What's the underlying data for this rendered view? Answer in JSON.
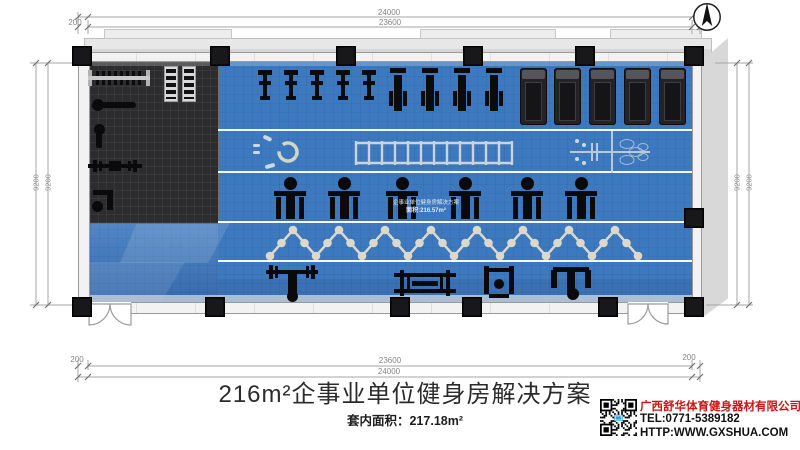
{
  "page": {
    "background": "#ffffff"
  },
  "compass": {
    "icon": "north-arrow"
  },
  "dims": {
    "top_total": "24000",
    "top_inner": "23600",
    "top_offset": "200",
    "bottom_inner": "23600",
    "bottom_total": "24000",
    "bottom_offset_left": "200",
    "bottom_offset_right": "200",
    "left_outer": "9200",
    "left_inner": "9200",
    "right_inner": "9200",
    "right_outer": "9200"
  },
  "plan": {
    "colors": {
      "floor_blue": "#3d79bf",
      "free_weight_floor": "#2c2c2e",
      "wall": "#f2f2f2",
      "column": "#18181a",
      "marking": "#ccd3da",
      "zigzag": "#dcd9cb"
    },
    "floor_label": {
      "line1": "企事业单位健身房解决方案",
      "line2": "面积:216.57m²"
    },
    "columns": {
      "top_x": [
        72,
        210,
        336,
        463,
        575,
        684
      ],
      "bottom_x": [
        72,
        205,
        390,
        462,
        598,
        684
      ],
      "right_side": [
        {
          "x": 684,
          "y": 208
        }
      ]
    },
    "equipment": {
      "groups": [
        {
          "type": "spin-bike",
          "y": 70,
          "xs": [
            258,
            284,
            310,
            336,
            362
          ]
        },
        {
          "type": "elliptical",
          "y": 67,
          "xs": [
            389,
            421,
            453,
            485
          ]
        },
        {
          "type": "treadmill",
          "y": 68,
          "xs": [
            520,
            554,
            589,
            624,
            659
          ]
        },
        {
          "type": "strength-machine",
          "y": 177,
          "xs": [
            274,
            328,
            386,
            449,
            511,
            565
          ]
        }
      ],
      "items": [
        {
          "type": "plate-rack",
          "x": 88,
          "y": 70
        },
        {
          "type": "dumbbell-rack",
          "x": 164,
          "y": 66
        },
        {
          "type": "dumbbell-rack",
          "x": 182,
          "y": 66
        },
        {
          "type": "adjustable-bench",
          "x": 92,
          "y": 98
        },
        {
          "type": "flat-bench",
          "x": 88,
          "y": 124
        },
        {
          "type": "barbell-bench",
          "x": 88,
          "y": 157
        },
        {
          "type": "preacher-bench",
          "x": 90,
          "y": 190
        },
        {
          "type": "bench-press-station",
          "x": 266,
          "y": 264
        },
        {
          "type": "barbell-rack",
          "x": 394,
          "y": 268
        },
        {
          "type": "squat-stand",
          "x": 484,
          "y": 266
        },
        {
          "type": "pendulum-machine",
          "x": 551,
          "y": 264
        }
      ]
    }
  },
  "footer": {
    "title": "216m²企事业单位健身房解决方案",
    "subtitle": "套内面积：217.18m²",
    "company": {
      "name": "广西舒华体育健身器材有限公司",
      "tel": "TEL:0771-5389182",
      "url": "HTTP:WWW.GXSHUA.COM"
    }
  }
}
